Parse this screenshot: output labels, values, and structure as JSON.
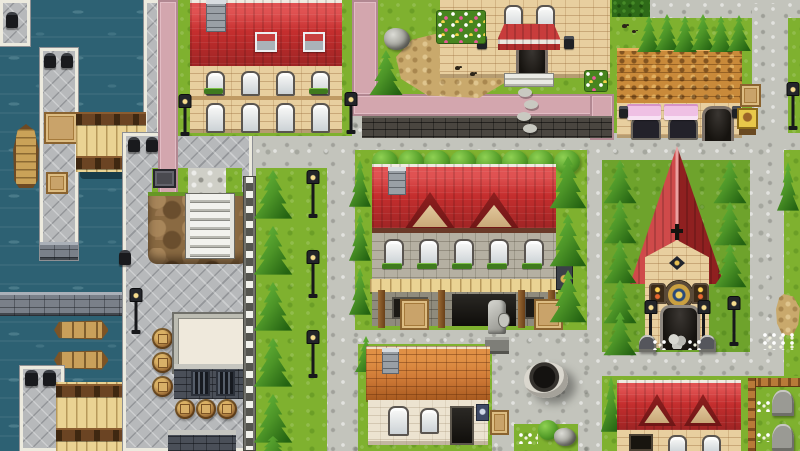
{
  "scene": {
    "type": "game-map",
    "style": "top-down 2D RPG town (RPG-Maker-like tileset)",
    "viewport": {
      "width": 800,
      "height": 451
    },
    "areas": [
      "harbor with dark water, stone piers, wooden footbridges and boats (left)",
      "cobblestone streets and town plaza (center)",
      "two-story inn with red roof and dormers (center)",
      "church with steep red roof and tree-lined yard (right)",
      "shop with pink awnings and shingled roof (top right)",
      "townhouse with skylights (top left)",
      "manor house with red canopy entrance (top middle)",
      "cottage with orange tiled roof and stone well (bottom middle)",
      "house with red roof and dormers, small fenced graveyard (bottom right)"
    ]
  },
  "palette": {
    "water": "#2d6173",
    "grass": "#7fb12f",
    "grassDark": "#6ea32c",
    "cobble": "#c3c4bc",
    "dock": "#b7b9bb",
    "pink": "#d3a6ae",
    "pinkEdge": "#b28892",
    "roofRed": "#c52e2e",
    "roofRedDark": "#9e2424",
    "roofOrange": "#c98a3a",
    "roofTile": "#cf7a36",
    "brick": "#e8cf9f",
    "stone": "#b5b0a2",
    "stoneDark": "#8f8b7d",
    "cream": "#ece3d0",
    "wood": "#ead393",
    "woodDark": "#6b4423",
    "treeLight": "#66b83a",
    "treeDark": "#246312",
    "hedge": "#2e6a18",
    "dirt": "#c9a96c",
    "cliff": "#8a6a42",
    "wallDark": "#4a4640",
    "iron": "#17181b",
    "awningPink": "#efc0e4"
  },
  "objects": {
    "buildings": [
      "townhouse-red-roof",
      "manor-house-canopy",
      "bakery-shop",
      "inn",
      "church",
      "cottage",
      "house-with-dormers",
      "stone-warehouse"
    ],
    "harbor": [
      "harbor-water",
      "stone-piers",
      "footbridge-north",
      "footbridge-south",
      "sail-boat",
      "rowboat-pair",
      "mooring-bollards",
      "cargo-crates",
      "seawall"
    ],
    "props": [
      "street-lamps",
      "conifer-trees",
      "round-bushes",
      "wooden-barrels",
      "stone-well",
      "knight-statue",
      "hanging-inn-sign",
      "bakery-sign",
      "stepping-stones",
      "cliff-stairs",
      "rock",
      "dirt-patches",
      "flower-beds",
      "gravestones",
      "wooden-fence",
      "hedge",
      "plank-walkway",
      "birds"
    ],
    "ground": [
      "cobblestone-street",
      "diamond-dock-paving",
      "lawns",
      "pink-paved-paths",
      "dark-stone-walls"
    ]
  }
}
